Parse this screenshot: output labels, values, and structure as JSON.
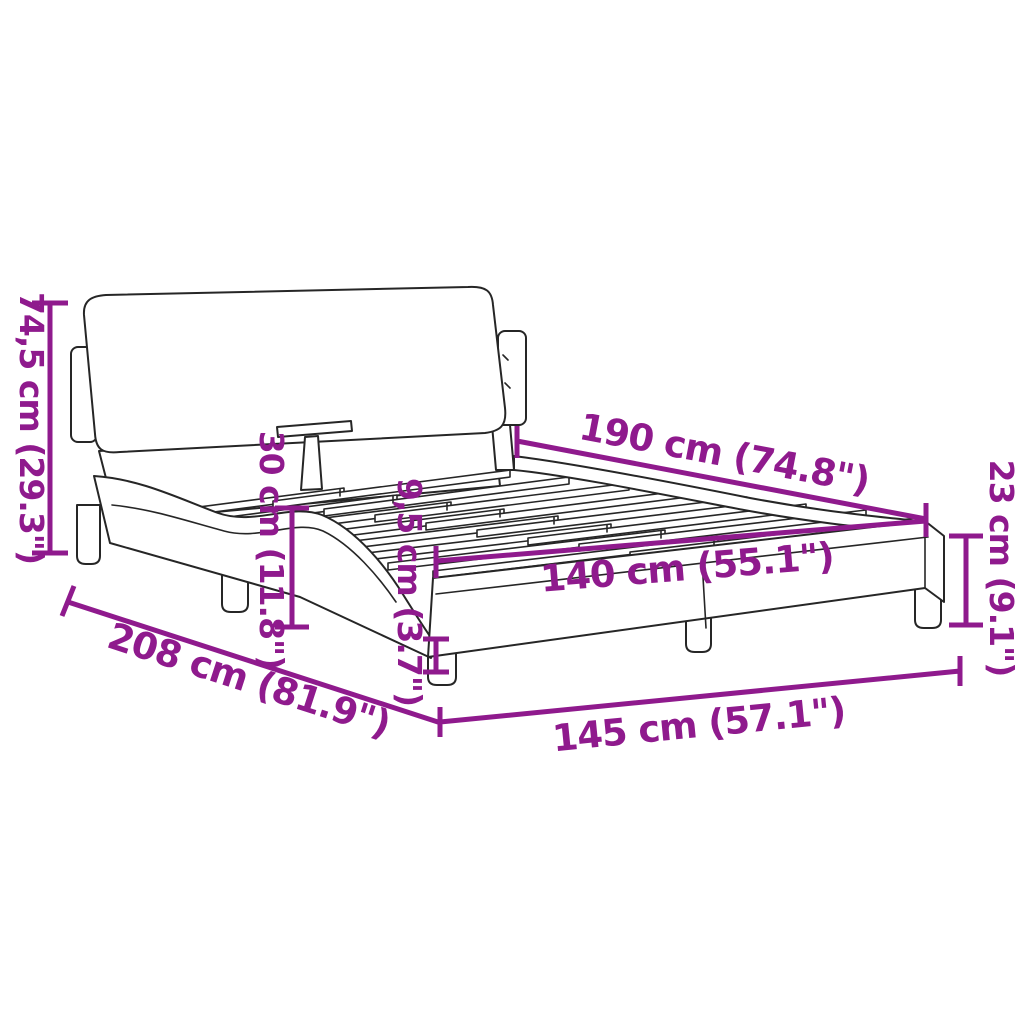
{
  "diagram": {
    "type": "product-dimension-diagram",
    "colors": {
      "accent": "#8f1a8d",
      "line_art": "#262626",
      "background": "#ffffff"
    },
    "dimensions": {
      "headboard_height": "74,5 cm (29.3\")",
      "platform_height": "30 cm (11.8\")",
      "base_rail_height": "9,5 cm (3.7\")",
      "mattress_length": "190 cm (74.8\")",
      "footend_height": "23 cm (9.1\")",
      "mattress_width": "140 cm (55.1\")",
      "total_length": "208 cm (81.9\")",
      "total_width": "145 cm (57.1\")"
    }
  }
}
